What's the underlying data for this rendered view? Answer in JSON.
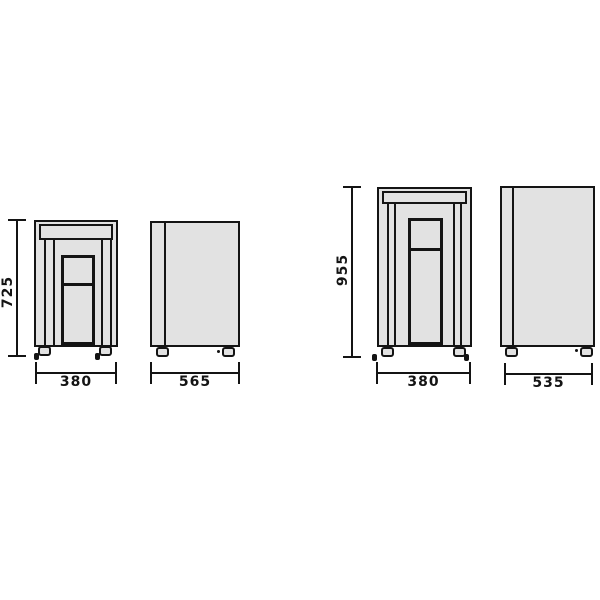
{
  "colors": {
    "line": "#141414",
    "panel_fill": "#e2e2e2",
    "background": "#ffffff"
  },
  "figure": {
    "description": "Technical dimension drawing of two cabinet models, each shown in front view and side view with millimeter dimensions",
    "models": [
      {
        "name": "model-a",
        "front": {
          "height_mm": "725",
          "width_mm": "380"
        },
        "side": {
          "depth_mm": "565"
        }
      },
      {
        "name": "model-b",
        "front": {
          "height_mm": "955",
          "width_mm": "380"
        },
        "side": {
          "depth_mm": "535"
        }
      }
    ]
  }
}
